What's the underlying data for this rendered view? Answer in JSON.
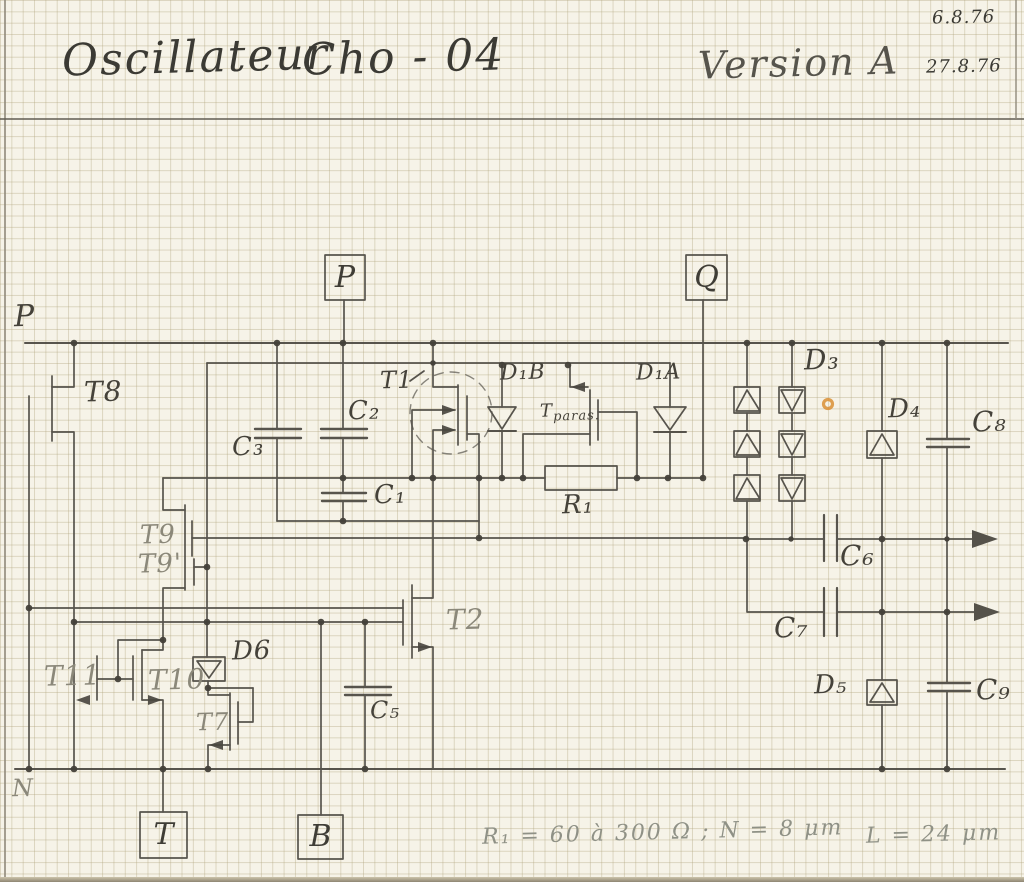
{
  "header": {
    "title_word1": "Oscillateur",
    "title_word2": "Cho - 04",
    "version": "Version A",
    "date1": "6.8.76",
    "date2": "27.8.76"
  },
  "rails": {
    "top": "P",
    "bottom": "N"
  },
  "terminals": {
    "p": "P",
    "q": "Q",
    "t": "T",
    "b": "B"
  },
  "labels": {
    "t1": "T1",
    "t2": "T2",
    "t7": "T7",
    "t8": "T8",
    "t9": "T9",
    "t9p": "T9'",
    "t10": "T10",
    "t11": "T11",
    "tparas_main": "T",
    "tparas_sub": "paras.",
    "c1": "C₁",
    "c2": "C₂",
    "c3": "C₃",
    "c5": "C₅",
    "c6": "C₆",
    "c7": "C₇",
    "c8": "C₈",
    "c9": "C₉",
    "d1b": "D₁B",
    "d1a": "D₁A",
    "d3": "D₃",
    "d4": "D₄",
    "d5": "D₅",
    "d6": "D6",
    "r1": "R₁"
  },
  "annotation": {
    "left": "R₁ = 60 à 300 Ω ; N = 8 μm",
    "right": "L = 24 μm"
  },
  "colors": {
    "pencil": "#4a4740",
    "pencil_light": "#8b887a",
    "paper": "#f6f3e8",
    "grid": "#d9d2ba",
    "accent_orange": "#d98f35"
  }
}
